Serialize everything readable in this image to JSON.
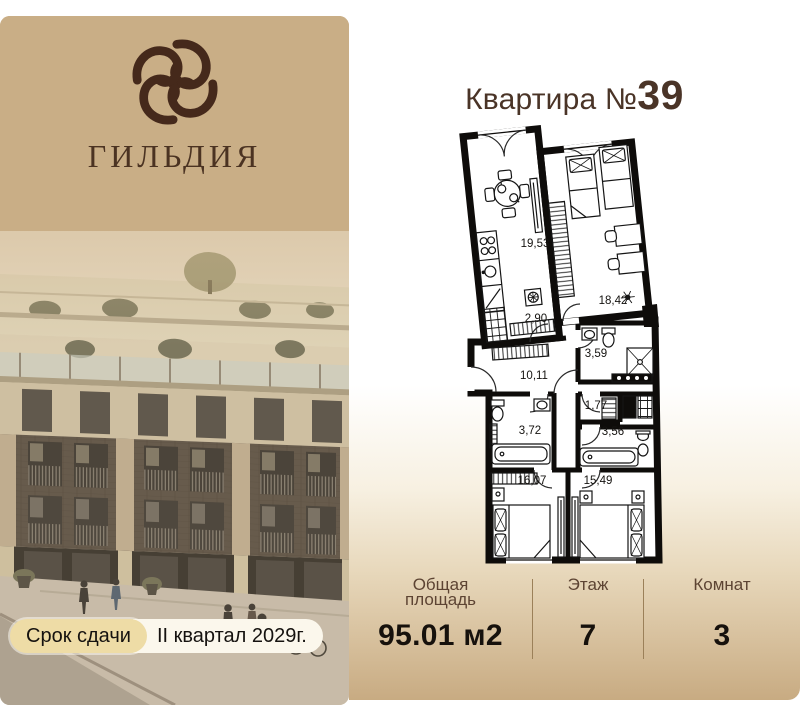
{
  "brand": {
    "name": "ГИЛЬДИЯ"
  },
  "delivery": {
    "label": "Срок сдачи",
    "value": "II квартал 2029г."
  },
  "apartment": {
    "title_prefix": "Квартира №",
    "number": "39"
  },
  "floor_plan": {
    "rooms": [
      {
        "area": "19,53"
      },
      {
        "area": "18,42"
      },
      {
        "area": "2,90"
      },
      {
        "area": "3,59"
      },
      {
        "area": "10,11"
      },
      {
        "area": "1,77"
      },
      {
        "area": "3,72"
      },
      {
        "area": "3,56"
      },
      {
        "area": "16,07"
      },
      {
        "area": "15,49"
      }
    ]
  },
  "stats": {
    "items": [
      {
        "label": "Общая площадь",
        "value": "95.01 м2"
      },
      {
        "label": "Этаж",
        "value": "7"
      },
      {
        "label": "Комнат",
        "value": "3"
      }
    ]
  },
  "colors": {
    "panel_tan": "#c9ae86",
    "brand_brown": "#45291b",
    "title_brown": "#4a3427",
    "badge_gold": "#eedca6",
    "badge_cream": "#fbf7ec",
    "gradient_tan": "#c8ab82",
    "label_brown": "#5d4433"
  }
}
